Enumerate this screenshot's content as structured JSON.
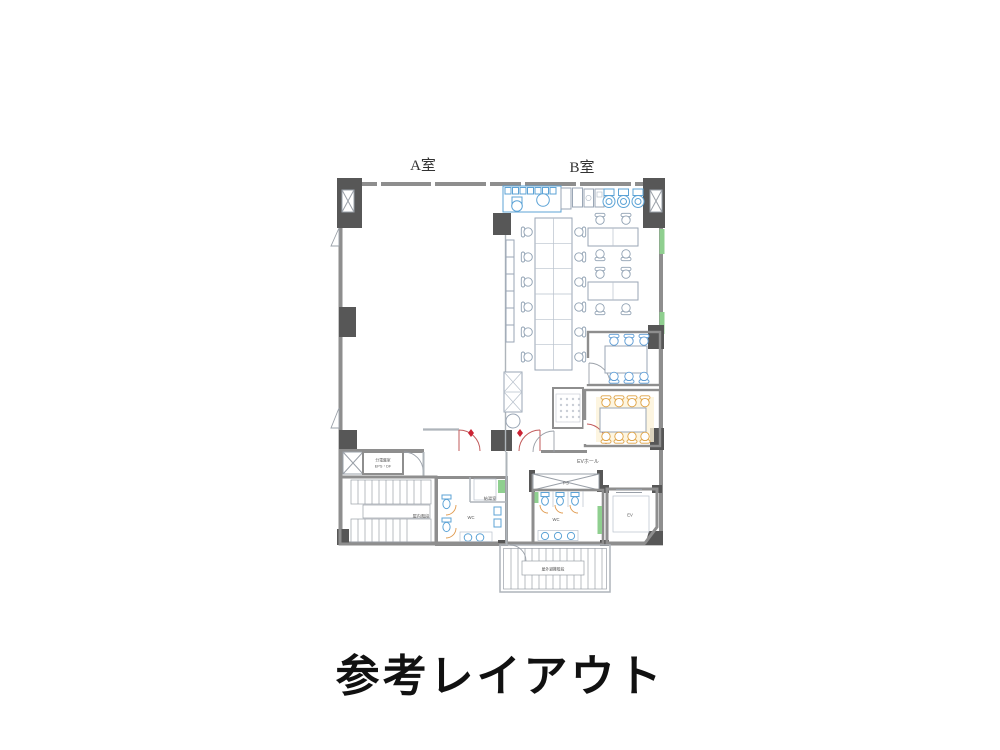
{
  "title": "参考レイアウト",
  "plan": {
    "room_labels": {
      "room_a": "A室",
      "room_b": "B室"
    },
    "area_labels": {
      "ev_hall": "EVホール",
      "pipe_shaft": "PS",
      "wc_main": "WC",
      "wc_sub": "WC",
      "elevator": "EV",
      "kitchenette": "給湯室",
      "indoor_stairs": "屋内階段",
      "electrical_room": "分電盤室",
      "electrical_room_sub": "EPS・DF",
      "outdoor_stairs": "屋外避難階段"
    },
    "colors": {
      "wall_dark": "#575757",
      "wall_gray": "#8e8e8e",
      "line_blue": "#a8c0d8",
      "furniture": "#9aa6b5",
      "chair_blue": "#5b9bd5",
      "chair_orange": "#dfa243",
      "accent_green": "#8fcf8f",
      "door_red": "#c25b5b",
      "fixture_blue": "#5ca3d6",
      "fixture_orange": "#e09a4e",
      "title_color": "#111111"
    }
  }
}
